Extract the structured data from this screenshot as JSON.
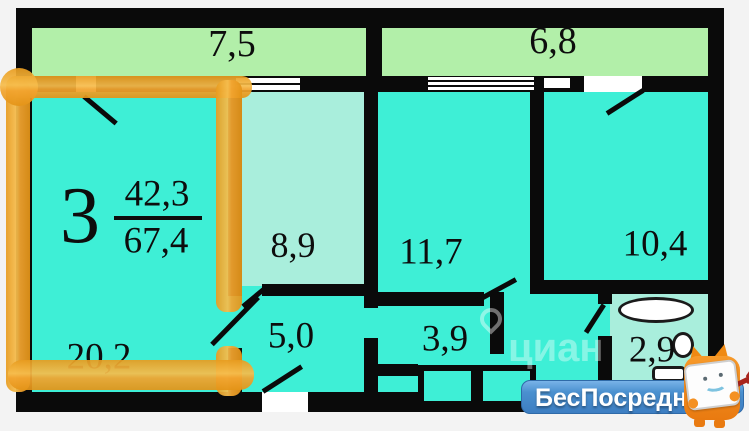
{
  "plan": {
    "apartment_number": "3",
    "area_living": "42,3",
    "area_total": "67,4",
    "balconies": [
      {
        "label": "7,5"
      },
      {
        "label": "6,8"
      }
    ],
    "rooms": [
      {
        "label": "20,2"
      },
      {
        "label": "8,9"
      },
      {
        "label": "5,0"
      },
      {
        "label": "11,7"
      },
      {
        "label": "3,9"
      },
      {
        "label": "10,4"
      },
      {
        "label": "2,9"
      }
    ]
  },
  "watermark": {
    "site_name": "БесПосредника",
    "domain_suffix": ".ru",
    "faint_text": "циан"
  },
  "colors": {
    "wall": "#0a0a0a",
    "room_teal": "#3eefd6",
    "hall_pale": "#a9eedc",
    "balcony_green": "#b2efa9",
    "highlight_orange": "#f2a42f",
    "banner_blue": "#4a90cf",
    "background": "#f3f3f3"
  }
}
